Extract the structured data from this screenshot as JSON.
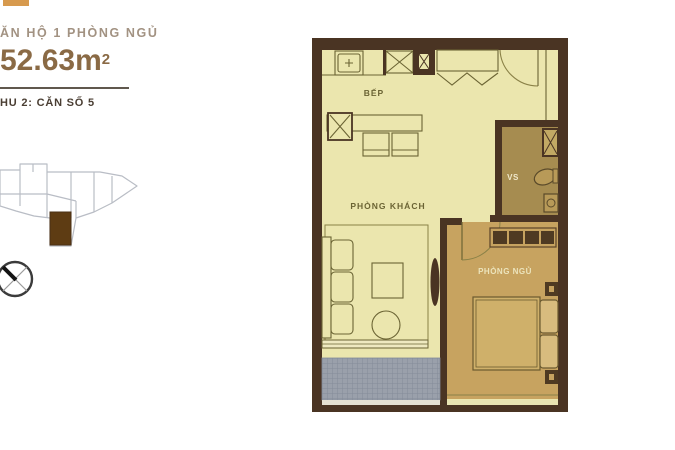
{
  "panel": {
    "title": "ĂN HỘ 1 PHÒNG NGỦ",
    "area_value": "52.63",
    "area_unit": "m",
    "area_sup": "2",
    "subtitle": "HU 2: CĂN SỐ 5"
  },
  "plan": {
    "labels": {
      "kitchen": "BẾP",
      "living": "PHÒNG KHÁCH",
      "bathroom": "VS",
      "bedroom": "PHÒNG NGỦ"
    },
    "colors": {
      "wall": "#4a3423",
      "floor": "#ebe6ae",
      "fixture_line": "#6b6434",
      "bath_floor": "#a68c50",
      "bedroom_floor": "#c7a360",
      "furniture_fill": "#cfb06a",
      "pillow_fill": "#d8bc7e",
      "balcony": "#9aa0ab",
      "balcony_grid": "#848b99",
      "keyplan_line": "#b9bdc5",
      "highlight_unit": "#5e3c13",
      "logo_accent": "#d79a4e",
      "area_text": "#8a6a45"
    }
  }
}
